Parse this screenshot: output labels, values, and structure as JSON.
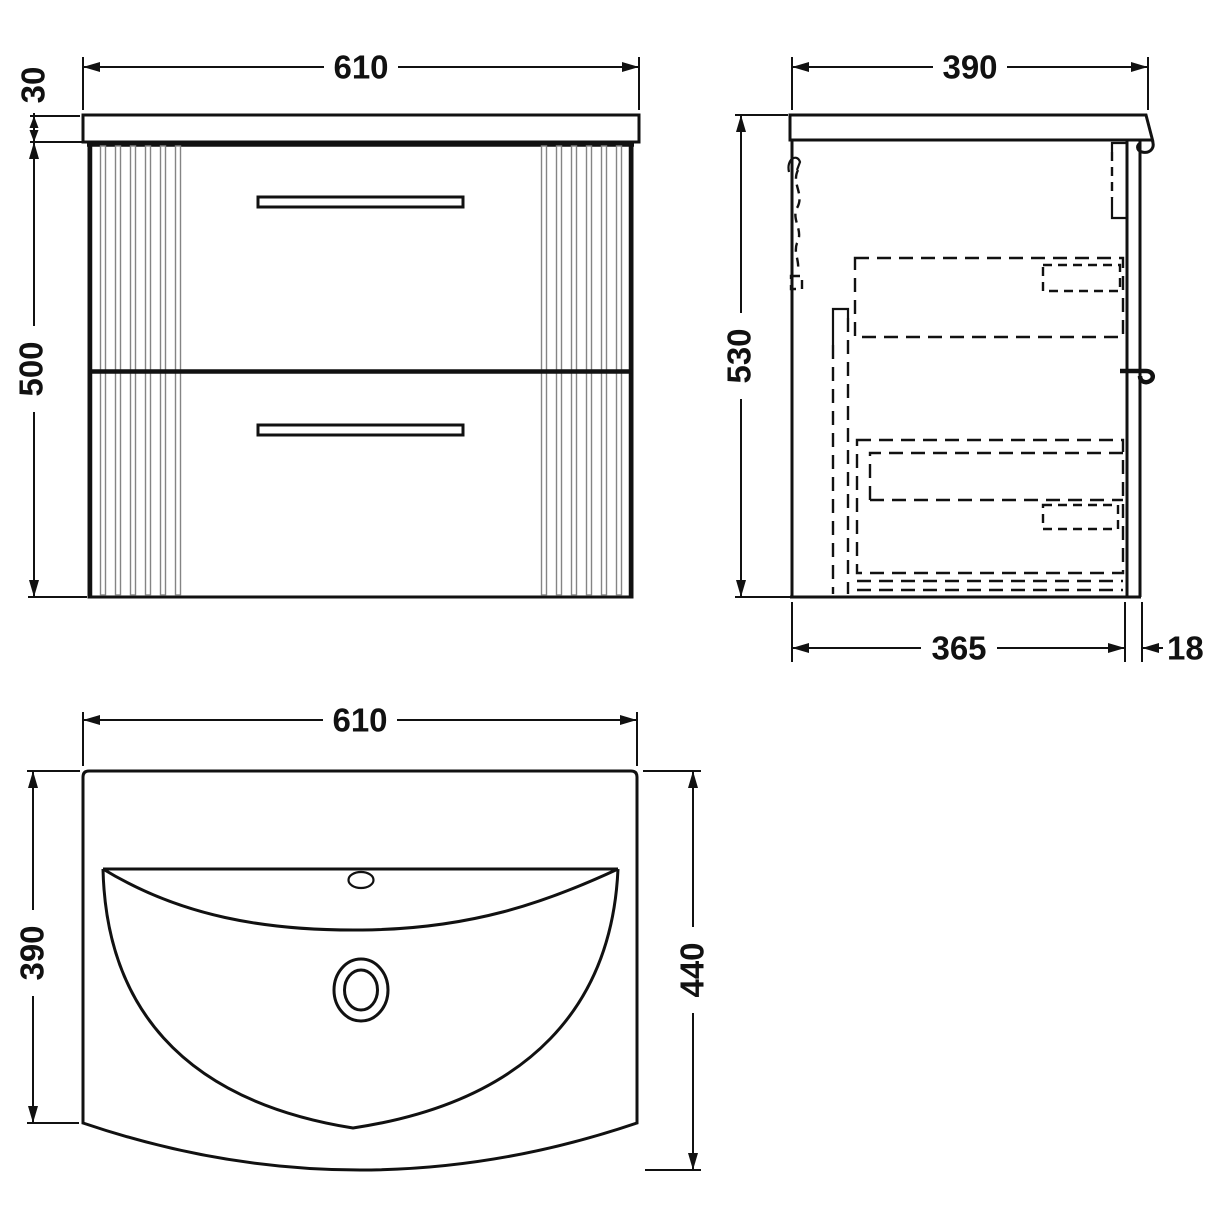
{
  "drawing": {
    "type": "technical-dimension-drawing",
    "subject": "wall-hung vanity unit with basin, three orthographic views",
    "colors": {
      "line": "#111111",
      "background": "#ffffff",
      "flute": "#848484"
    },
    "views": {
      "front": {
        "label": "front-view",
        "dims": {
          "width": "610",
          "counter_thickness": "30",
          "body_height": "500"
        }
      },
      "side": {
        "label": "side-view",
        "dims": {
          "depth": "390",
          "height": "530",
          "internal_depth": "365",
          "back_panel": "18"
        }
      },
      "plan": {
        "label": "plan-view",
        "dims": {
          "width": "610",
          "depth": "390",
          "overall_depth": "440"
        }
      }
    }
  }
}
